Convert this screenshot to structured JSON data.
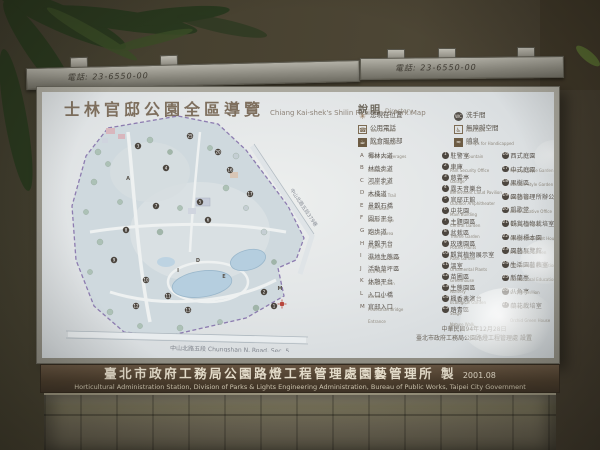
{
  "frame": {
    "phone_left": "電話: 23-6550-00",
    "phone_right": "電話: 23-6550-00"
  },
  "sign": {
    "title_zh": "士林官邸公園全區導覽",
    "title_en": "Chiang Kai-shek's Shilin Residence Park Map",
    "glossary": {
      "heading_zh": "說明",
      "heading_en": "Directory",
      "items": [
        {
          "icon": "you-are-here",
          "zh": "您現在位置",
          "en": "You Are Here"
        },
        {
          "icon": "restroom",
          "zh": "洗手間",
          "en": "Restroom"
        },
        {
          "icon": "public-phone",
          "zh": "公用電話",
          "en": "Public Phone"
        },
        {
          "icon": "ramp",
          "zh": "無障礙空間",
          "en": "Ramps for Handicapped"
        },
        {
          "icon": "food",
          "zh": "飲食服務部",
          "en": "Food & Beverages"
        },
        {
          "icon": "fountain",
          "zh": "噴泉",
          "en": "Fountain"
        }
      ]
    },
    "features_lettered": [
      {
        "key": "A",
        "zh": "椰林大道",
        "en": "Palm Drive"
      },
      {
        "key": "B",
        "zh": "林蔭步道",
        "en": "Green Trail"
      },
      {
        "key": "C",
        "zh": "河岸步道",
        "en": "Riverside Trail"
      },
      {
        "key": "D",
        "zh": "木棧道",
        "en": "Boardwalk"
      },
      {
        "key": "E",
        "zh": "景觀石橋",
        "en": "Stone Bridge"
      },
      {
        "key": "F",
        "zh": "圓形平台",
        "en": "Activity Area"
      },
      {
        "key": "G",
        "zh": "跑步道",
        "en": "Jogging Trail"
      },
      {
        "key": "H",
        "zh": "景觀平台",
        "en": "Ground Lookout"
      },
      {
        "key": "I",
        "zh": "濕地生態區",
        "en": "Eco Pond"
      },
      {
        "key": "J",
        "zh": "活動草坪區",
        "en": "Activity Lawn"
      },
      {
        "key": "K",
        "zh": "休憩平台",
        "en": "Benches"
      },
      {
        "key": "L",
        "zh": "入口小橋",
        "en": "Pedestrian Bridge"
      },
      {
        "key": "M",
        "zh": "官邸入口",
        "en": "Entrance"
      }
    ],
    "features_numbered_col1": [
      {
        "num": 1,
        "zh": "駐警室",
        "en": "Park Security Office"
      },
      {
        "num": 2,
        "zh": "車庫",
        "en": "Garage"
      },
      {
        "num": 3,
        "zh": "慈雲亭",
        "en": "Benevolent Cloud Pavilion"
      },
      {
        "num": 4,
        "zh": "露天音樂台",
        "en": "Outdoor Amphitheater"
      },
      {
        "num": 5,
        "zh": "官邸正館",
        "en": "Main Building"
      },
      {
        "num": 6,
        "zh": "中花園",
        "en": "Central Garden"
      },
      {
        "num": 7,
        "zh": "主題園區",
        "en": "Theme Garden"
      },
      {
        "num": 8,
        "zh": "盆栽區",
        "en": "Potted Plants"
      },
      {
        "num": 9,
        "zh": "玫瑰園區",
        "en": "Rose Garden"
      },
      {
        "num": 10,
        "zh": "觀賞植物展示室",
        "en": "Ornamental Plants"
      },
      {
        "num": 11,
        "zh": "溫室",
        "en": "Greenhouse"
      },
      {
        "num": 12,
        "zh": "苗圃區",
        "en": "Nursery"
      },
      {
        "num": 13,
        "zh": "生態園區",
        "en": "Ecological Garden"
      },
      {
        "num": 14,
        "zh": "楓香表演台",
        "en": "Stage"
      },
      {
        "num": 15,
        "zh": "踏青區",
        "en": "Nature Walk"
      }
    ],
    "features_numbered_col2": [
      {
        "num": 16,
        "zh": "西式庭園",
        "en": "Western Style Garden"
      },
      {
        "num": 17,
        "zh": "中式庭園",
        "en": "Chinese Style Garden"
      },
      {
        "num": 18,
        "zh": "果樹區",
        "en": "Fruit Trees"
      },
      {
        "num": 19,
        "zh": "園藝管理所辦公室",
        "en": "Administrative Office"
      },
      {
        "num": 20,
        "zh": "凱歌堂",
        "en": "Victory Chapel"
      },
      {
        "num": 21,
        "zh": "觀賞植物栽培室",
        "en": "Ornamental Plant House"
      },
      {
        "num": 22,
        "zh": "果樹標本園",
        "en": "Fruit Trees Garden"
      },
      {
        "num": 23,
        "zh": "園藝展覽館",
        "en": "Horticultural Exhibition Hall"
      },
      {
        "num": 24,
        "zh": "生活園藝教室",
        "en": "Horticultural Education Classroom"
      },
      {
        "num": 25,
        "zh": "新蘭亭",
        "en": "Orchid Pavilion"
      },
      {
        "num": 26,
        "zh": "八角亭",
        "en": "Pavilion"
      },
      {
        "num": 27,
        "zh": "蘭花栽培室",
        "en": "Orchid Green House"
      }
    ],
    "setup_date": "中華民國94年12月28日",
    "setup_by": "臺北市政府工務局公園路燈工程管理處 設置",
    "footer_zh": "臺北市政府工務局公園路燈工程管理處園藝管理所 製",
    "footer_date": "2001.08",
    "footer_en": "Horticultural Administration Station, Division of Parks & Lights Engineering Administration, Bureau of Public Works, Taipei City Government",
    "map": {
      "road_bottom": "中山北路五段 Chungshan N. Road, Sec. 5",
      "road_right": "中山北路五段379巷",
      "markers": [
        [
          224,
          194,
          "1"
        ],
        [
          214,
          180,
          "2"
        ],
        [
          88,
          34,
          "3"
        ],
        [
          116,
          56,
          "4"
        ],
        [
          150,
          90,
          "5"
        ],
        [
          158,
          108,
          "6"
        ],
        [
          106,
          94,
          "7"
        ],
        [
          76,
          118,
          "8"
        ],
        [
          64,
          148,
          "9"
        ],
        [
          96,
          168,
          "10"
        ],
        [
          118,
          184,
          "11"
        ],
        [
          86,
          194,
          "12"
        ],
        [
          138,
          198,
          "13"
        ],
        [
          180,
          58,
          "16"
        ],
        [
          200,
          82,
          "17"
        ],
        [
          168,
          40,
          "20"
        ],
        [
          140,
          24,
          "25"
        ],
        [
          78,
          66,
          "A"
        ],
        [
          148,
          148,
          "D"
        ],
        [
          174,
          164,
          "E"
        ],
        [
          128,
          158,
          "I"
        ],
        [
          230,
          176,
          "M"
        ]
      ]
    }
  },
  "colors": {
    "board_bg": "#e4e7e8",
    "map_boundary": "#8d7cb0",
    "pond": "#b5cedf",
    "footer_band": "#4a3c2c",
    "title_text": "#7e6f5e",
    "you_are_here": "#b8463c"
  }
}
